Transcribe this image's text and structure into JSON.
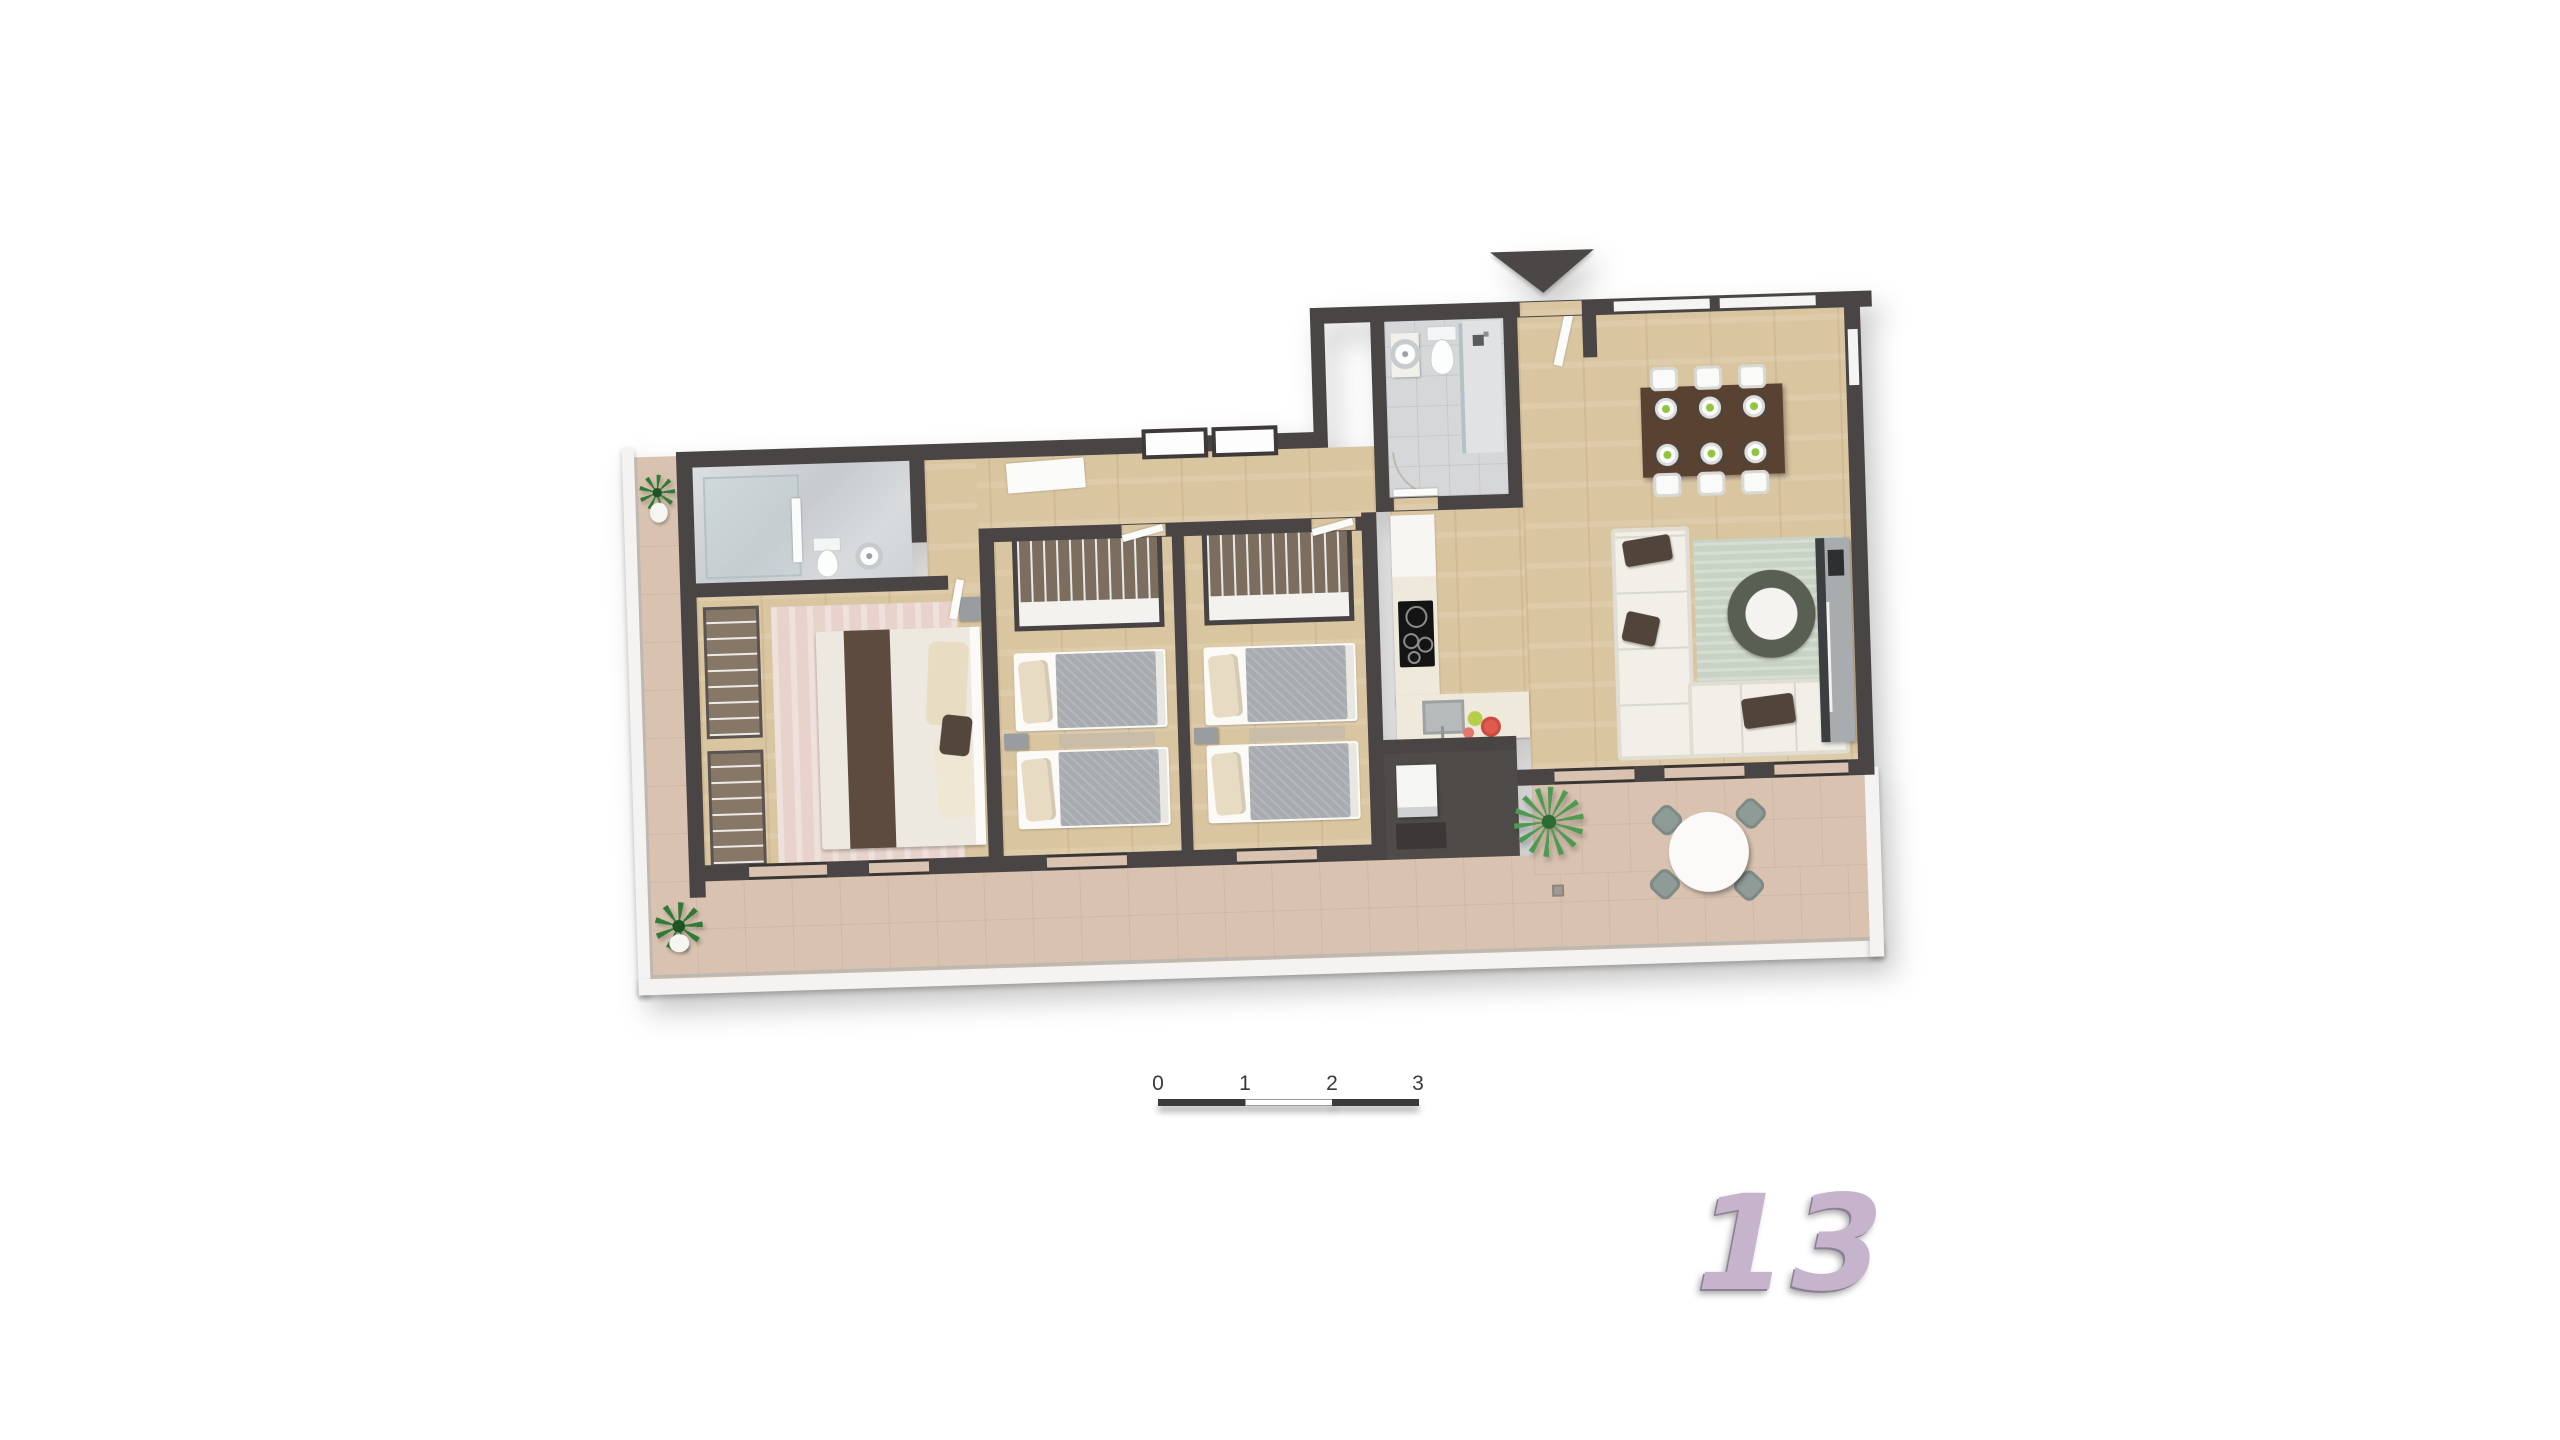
{
  "scene": {
    "type": "3d-floor-plan-render",
    "background_color": "#ffffff",
    "unit": {
      "number": "13",
      "number_color": "#c6b4cc"
    },
    "entrance": {
      "icon": "entrance-arrow",
      "direction": "down",
      "color": "#4a4746"
    }
  },
  "scale_bar": {
    "labels": [
      "0",
      "1",
      "2",
      "3"
    ],
    "dark_color": "#3a3a3a",
    "light_color": "#ffffff"
  },
  "palette": {
    "wall": "#4a4545",
    "wood_floor": "#d9c5a0",
    "bathroom_tile": "#d5d7d9",
    "terrace_tile": "#d9c3b0",
    "bed_duvet_gray": "#a8acb1",
    "pillow_cream": "#e7dcc3",
    "sofa_white": "#f1efe8",
    "pillow_brown": "#50443b",
    "living_rug_sage": "#c9d3c5",
    "master_rug_pink": "#e7d3cb",
    "dining_table_brown": "#5a4233",
    "plate_accent_green": "#8fc63e",
    "bowl_red": "#e05a4e",
    "bowl_yellow_green": "#b5cf4a",
    "plant_green": "#2f7a35",
    "outdoor_chair_gray_green": "#8f9b97"
  },
  "rooms": [
    {
      "name": "ensuite-bathroom",
      "floor": "marble",
      "furniture": [
        "shower",
        "toilet",
        "round-basin"
      ]
    },
    {
      "name": "master-bedroom",
      "floor": "wood",
      "furniture": [
        "double-bed",
        "open-wardrobes",
        "rug",
        "nightstand"
      ]
    },
    {
      "name": "twin-bedroom-1",
      "floor": "wood",
      "furniture": [
        "single-bed",
        "single-bed",
        "open-wardrobe",
        "nightstand",
        "rug"
      ]
    },
    {
      "name": "twin-bedroom-2",
      "floor": "wood",
      "furniture": [
        "single-bed",
        "single-bed",
        "open-wardrobe",
        "nightstand",
        "rug"
      ]
    },
    {
      "name": "main-bathroom",
      "floor": "tile",
      "furniture": [
        "vanity-basin",
        "toilet",
        "shower"
      ]
    },
    {
      "name": "entry-hall",
      "floor": "wood",
      "furniture": [
        "entrance-door"
      ]
    },
    {
      "name": "kitchen",
      "floor": "wood",
      "furniture": [
        "counter",
        "cooktop",
        "sink",
        "bowls"
      ]
    },
    {
      "name": "dining-area",
      "floor": "wood",
      "furniture": [
        "dining-table",
        "six-chairs",
        "six-place-settings"
      ]
    },
    {
      "name": "living-room",
      "floor": "wood",
      "furniture": [
        "corner-sofa",
        "rug",
        "round-coffee-table",
        "tv-unit"
      ]
    },
    {
      "name": "utility-store",
      "floor": "dark",
      "furniture": [
        "washing-machine"
      ]
    },
    {
      "name": "terrace",
      "floor": "terracotta-tile",
      "furniture": [
        "round-table",
        "four-chairs",
        "palm-plant",
        "potted-plant",
        "potted-plant",
        "floor-drain",
        "glass-balustrade"
      ]
    }
  ]
}
